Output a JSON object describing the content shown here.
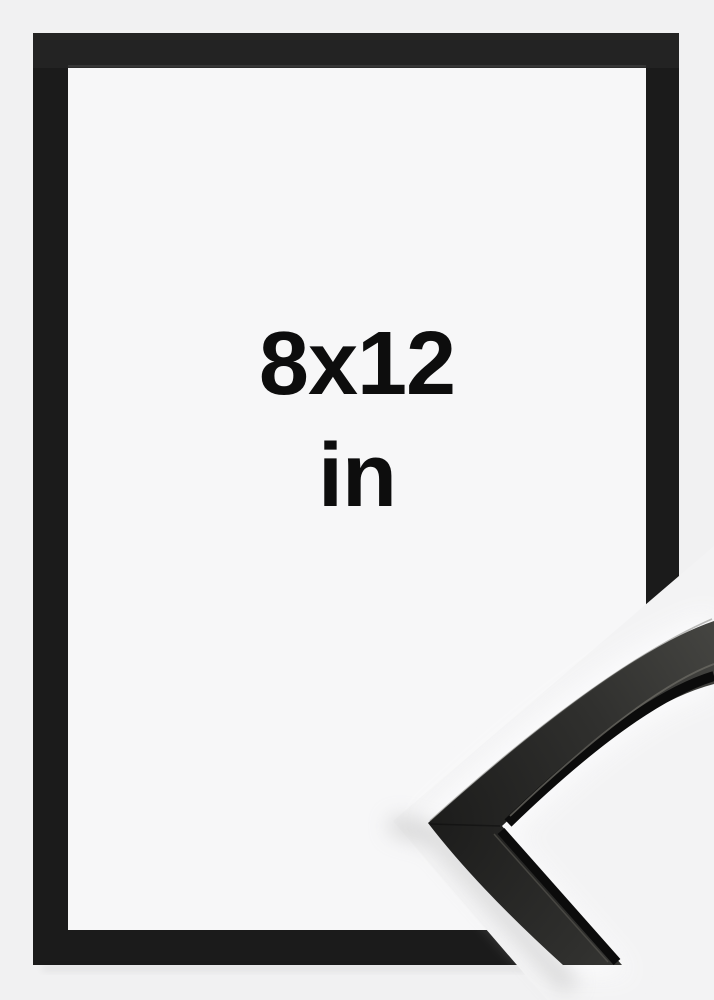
{
  "size_label": {
    "dimensions": "8x12",
    "unit": "in"
  },
  "frame": {
    "style": "black flat picture frame",
    "corner_detail": "black frame moulding corner close-up"
  },
  "colors": {
    "background": "#f1f1f2",
    "paper": "#f7f7f8",
    "frame_black": "#1b1b1b",
    "cutout_white": "#f3f3f4",
    "moulding_dark": "#1c1c1b",
    "moulding_mid": "#30302e",
    "moulding_light": "#4c4c48",
    "text": "#0d0d0d"
  }
}
